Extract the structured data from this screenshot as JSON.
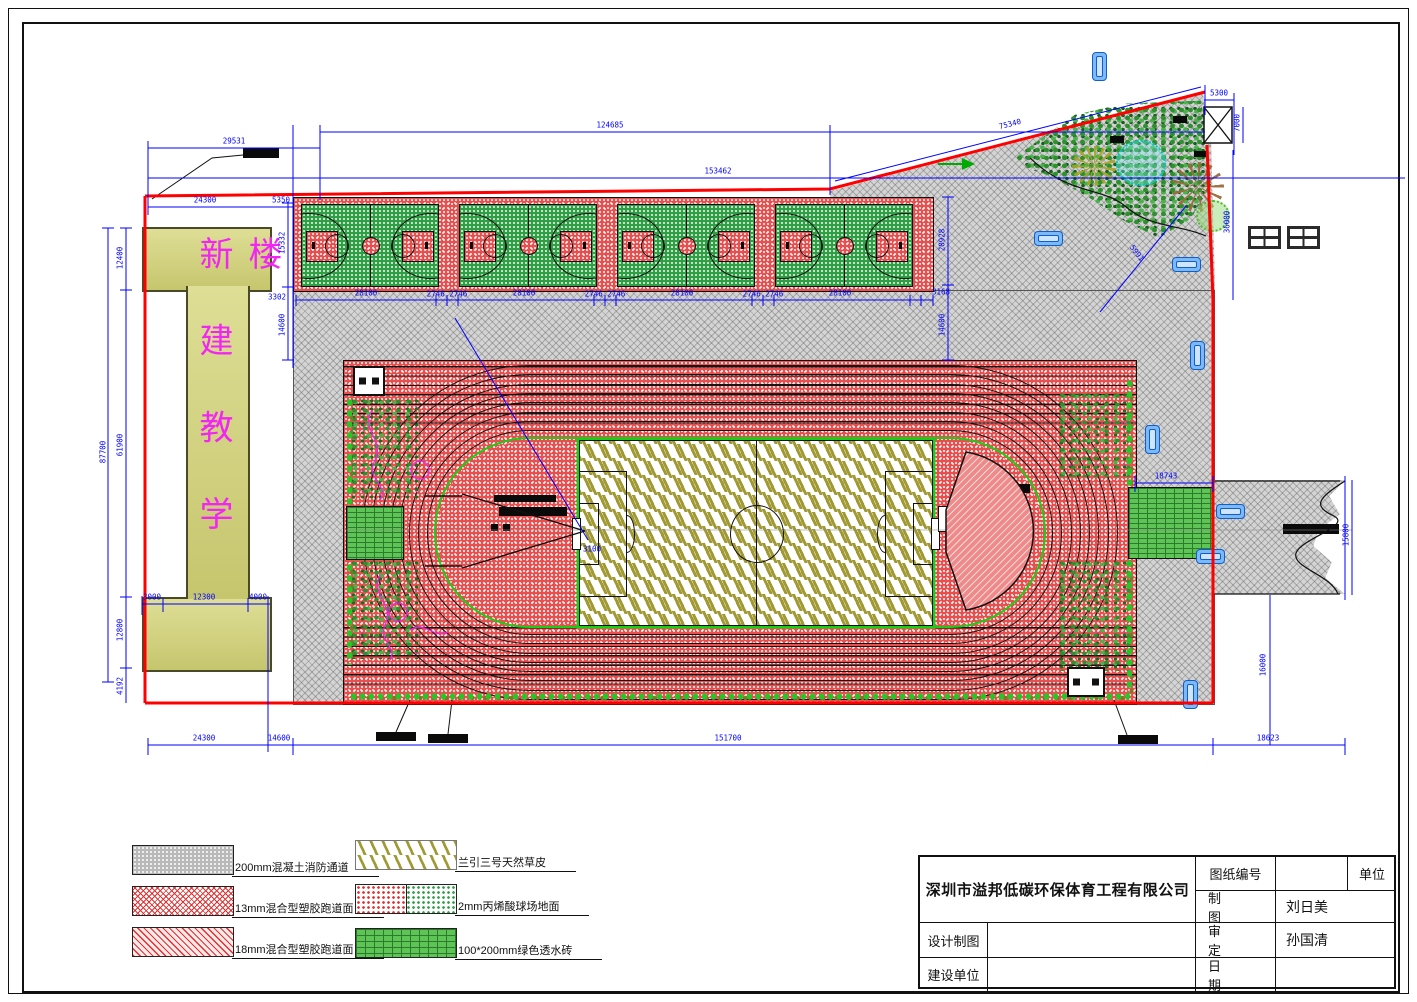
{
  "title_block": {
    "company": "深圳市溢邦低碳环保体育工程有限公司",
    "drawing_no_label": "图纸编号",
    "unit_label": "单位",
    "drafter_label": "制图",
    "drafter_value": "刘日美",
    "design_label": "设计制图",
    "approver_label": "审定",
    "approver_value": "孙国清",
    "builder_label": "建设单位",
    "date_label": "日期"
  },
  "building": {
    "label": "新建教学楼"
  },
  "legend": {
    "items": [
      {
        "text": "200mm混凝土消防通道",
        "swatch": "gray"
      },
      {
        "text": "13mm混合型塑胶跑道面",
        "swatch": "red-cross"
      },
      {
        "text": "18mm混合型塑胶跑道面",
        "swatch": "red-diag"
      },
      {
        "text": "兰引三号天然草皮",
        "swatch": "turf"
      },
      {
        "text": "2mm丙烯酸球场地面",
        "swatch": "acrylic"
      },
      {
        "text": "100*200mm绿色透水砖",
        "swatch": "brick"
      }
    ]
  },
  "dimensions": [
    {
      "t": "29531",
      "x": 234,
      "y": 141
    },
    {
      "t": "124685",
      "x": 610,
      "y": 125
    },
    {
      "t": "153462",
      "x": 718,
      "y": 171
    },
    {
      "t": "5300",
      "x": 1219,
      "y": 93
    },
    {
      "t": "75340",
      "x": 1010,
      "y": 124,
      "r": -14
    },
    {
      "t": "24300",
      "x": 205,
      "y": 200
    },
    {
      "t": "5350",
      "x": 281,
      "y": 200
    },
    {
      "t": "28100",
      "x": 366,
      "y": 293
    },
    {
      "t": "2746 2746",
      "x": 447,
      "y": 294
    },
    {
      "t": "28100",
      "x": 524,
      "y": 293
    },
    {
      "t": "2746 2746",
      "x": 605,
      "y": 294
    },
    {
      "t": "28100",
      "x": 682,
      "y": 293
    },
    {
      "t": "2746 2746",
      "x": 763,
      "y": 294
    },
    {
      "t": "28100",
      "x": 840,
      "y": 293
    },
    {
      "t": "12400",
      "x": 120,
      "y": 258,
      "r": -90
    },
    {
      "t": "87700",
      "x": 103,
      "y": 452,
      "r": -90
    },
    {
      "t": "61900",
      "x": 120,
      "y": 445,
      "r": -90
    },
    {
      "t": "12800",
      "x": 120,
      "y": 630,
      "r": -90
    },
    {
      "t": "4192",
      "x": 120,
      "y": 686,
      "r": -90
    },
    {
      "t": "3000",
      "x": 152,
      "y": 597
    },
    {
      "t": "12300",
      "x": 204,
      "y": 597
    },
    {
      "t": "4000",
      "x": 258,
      "y": 597
    },
    {
      "t": "15332",
      "x": 282,
      "y": 243,
      "r": -90
    },
    {
      "t": "3302",
      "x": 277,
      "y": 297
    },
    {
      "t": "14600",
      "x": 282,
      "y": 325,
      "r": -90
    },
    {
      "t": "20928",
      "x": 942,
      "y": 240,
      "r": -90
    },
    {
      "t": "3168",
      "x": 941,
      "y": 292
    },
    {
      "t": "14600",
      "x": 942,
      "y": 325,
      "r": -90
    },
    {
      "t": "7000",
      "x": 1237,
      "y": 123,
      "r": -90
    },
    {
      "t": "36000",
      "x": 1227,
      "y": 222,
      "r": -90
    },
    {
      "t": "5991",
      "x": 1137,
      "y": 253,
      "r": 52
    },
    {
      "t": "18743",
      "x": 1166,
      "y": 476
    },
    {
      "t": "15800",
      "x": 1346,
      "y": 535,
      "r": -90
    },
    {
      "t": "16000",
      "x": 1263,
      "y": 665,
      "r": -90
    },
    {
      "t": "3100",
      "x": 592,
      "y": 549
    },
    {
      "t": "24300",
      "x": 204,
      "y": 738
    },
    {
      "t": "14600",
      "x": 279,
      "y": 738
    },
    {
      "t": "151700",
      "x": 728,
      "y": 738
    },
    {
      "t": "18623",
      "x": 1268,
      "y": 738
    }
  ],
  "colors": {
    "boundary_red": "#ff0000",
    "dimension_blue": "#0000ff",
    "track_red": "#e85050",
    "court_green": "#2f9e44",
    "building_fill": "#d2d280",
    "building_label_magenta": "#f226f2",
    "pavement_gray": "#d4d4d4",
    "walkway_green": "#5ec455"
  }
}
